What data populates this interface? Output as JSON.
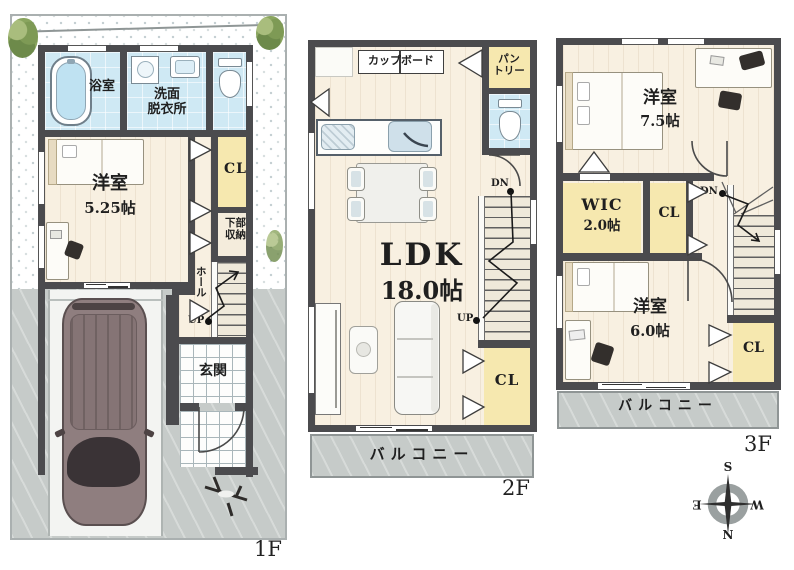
{
  "colors": {
    "wall": "#4b4b4e",
    "wet_area": "#cfe9f4",
    "closet": "#f6e8af",
    "wood_floor": "#f8f0e1",
    "concrete": "#c6cbc9",
    "plant_green": "#7e9a55",
    "car_body": "#8f7e7f"
  },
  "f1": {
    "floor_label": "1F",
    "bath": "浴室",
    "washroom": [
      "洗面",
      "脱衣所"
    ],
    "bedroom_name": "洋室",
    "bedroom_size": "5.25帖",
    "closet": "CL",
    "under_stairs_storage": [
      "下部",
      "収納"
    ],
    "hall": "ホール",
    "stairs_up": "UP",
    "entrance": "玄関"
  },
  "f2": {
    "floor_label": "2F",
    "cupboard": "カップボード",
    "pantry": [
      "パン",
      "トリー"
    ],
    "stairs_down": "DN",
    "ldk_name": "LDK",
    "ldk_size": "18.0帖",
    "stairs_up": "UP",
    "closet": "CL",
    "balcony": "バルコニー"
  },
  "f3": {
    "floor_label": "3F",
    "bedroom1_name": "洋室",
    "bedroom1_size": "7.5帖",
    "wic_name": "WIC",
    "wic_size": "2.0帖",
    "closet1": "CL",
    "stairs_down": "DN",
    "bedroom2_name": "洋室",
    "bedroom2_size": "6.0帖",
    "closet2": "CL",
    "balcony": "バルコニー"
  },
  "compass": {
    "north": "N",
    "south": "S",
    "east": "E",
    "west": "W"
  }
}
